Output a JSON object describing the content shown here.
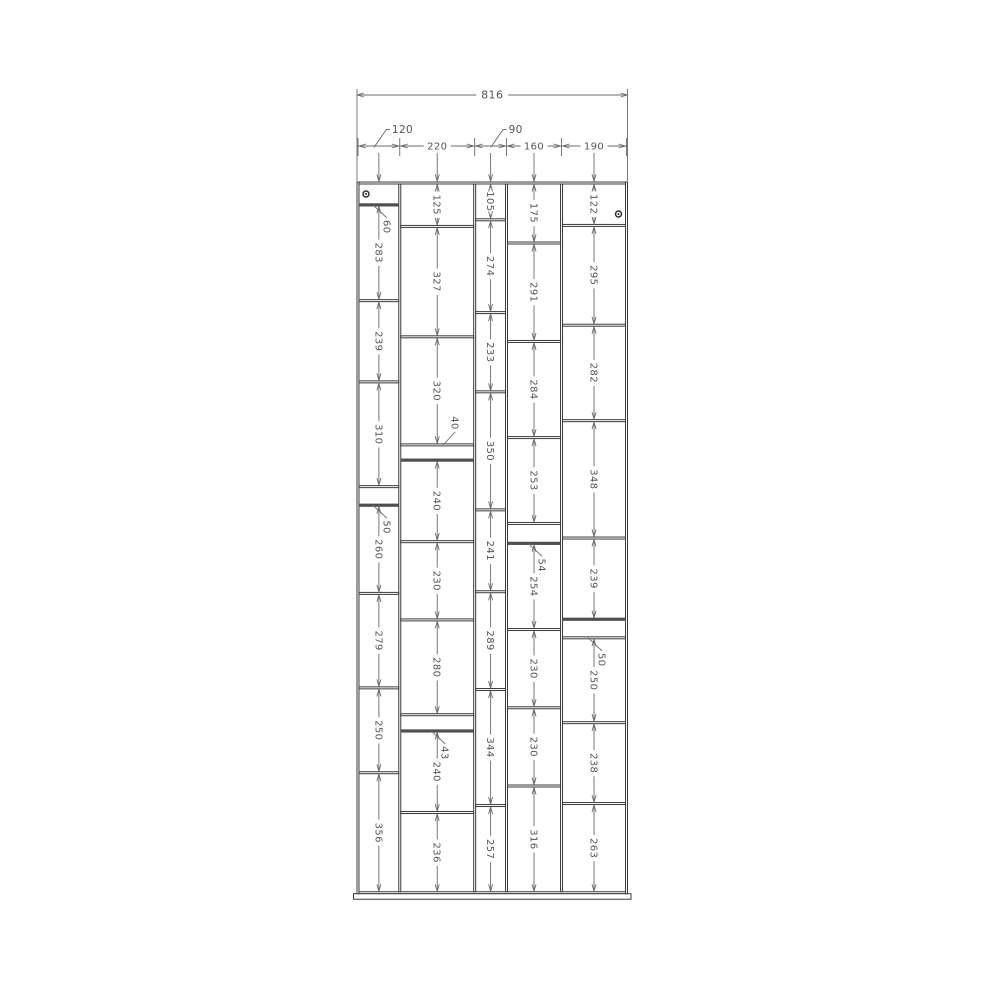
{
  "drawing": {
    "type": "furniture-dimension-drawing",
    "overall_width_label": "816",
    "panel_thickness_mm": 6,
    "column_width_labels": [
      {
        "label": "120",
        "placement": "leader"
      },
      {
        "label": "220",
        "placement": "inline"
      },
      {
        "label": "90",
        "placement": "leader"
      },
      {
        "label": "160",
        "placement": "inline"
      },
      {
        "label": "190",
        "placement": "inline"
      }
    ],
    "columns": [
      {
        "width_mm": 120,
        "screw": "top-left",
        "dark_shelves_after": [
          0,
          4
        ],
        "cells": [
          {
            "h": 60,
            "label": "60",
            "leader": "below"
          },
          {
            "h": 283,
            "label": "283"
          },
          {
            "h": 239,
            "label": "239"
          },
          {
            "h": 310,
            "label": "310"
          },
          {
            "h": 50,
            "label": "50",
            "leader": "below"
          },
          {
            "h": 260,
            "label": "260"
          },
          {
            "h": 279,
            "label": "279"
          },
          {
            "h": 250,
            "label": "250"
          },
          {
            "h": 356,
            "label": "356"
          }
        ]
      },
      {
        "width_mm": 220,
        "dark_shelves_after": [
          3,
          7
        ],
        "cells": [
          {
            "h": 125,
            "label": "125"
          },
          {
            "h": 327,
            "label": "327"
          },
          {
            "h": 320,
            "label": "320"
          },
          {
            "h": 40,
            "label": "40",
            "leader": "above"
          },
          {
            "h": 240,
            "label": "240"
          },
          {
            "h": 230,
            "label": "230"
          },
          {
            "h": 280,
            "label": "280"
          },
          {
            "h": 43,
            "label": "43",
            "leader": "below"
          },
          {
            "h": 240,
            "label": "240"
          },
          {
            "h": 236,
            "label": "236"
          }
        ]
      },
      {
        "width_mm": 90,
        "dark_shelves_after": [],
        "cells": [
          {
            "h": 105,
            "label": "105"
          },
          {
            "h": 274,
            "label": "274"
          },
          {
            "h": 233,
            "label": "233"
          },
          {
            "h": 350,
            "label": "350"
          },
          {
            "h": 241,
            "label": "241"
          },
          {
            "h": 289,
            "label": "289"
          },
          {
            "h": 344,
            "label": "344"
          },
          {
            "h": 257,
            "label": "257"
          }
        ]
      },
      {
        "width_mm": 160,
        "dark_shelves_after": [
          4
        ],
        "cells": [
          {
            "h": 175,
            "label": "175"
          },
          {
            "h": 291,
            "label": "291"
          },
          {
            "h": 284,
            "label": "284"
          },
          {
            "h": 253,
            "label": "253"
          },
          {
            "h": 54,
            "label": "54",
            "leader": "below"
          },
          {
            "h": 254,
            "label": "254"
          },
          {
            "h": 230,
            "label": "230"
          },
          {
            "h": 230,
            "label": "230"
          },
          {
            "h": 316,
            "label": "316"
          }
        ]
      },
      {
        "width_mm": 190,
        "screw": "top-right",
        "dark_shelves_after": [
          4
        ],
        "cells": [
          {
            "h": 122,
            "label": "122"
          },
          {
            "h": 295,
            "label": "295"
          },
          {
            "h": 282,
            "label": "282"
          },
          {
            "h": 348,
            "label": "348"
          },
          {
            "h": 239,
            "label": "239"
          },
          {
            "h": 50,
            "label": "50",
            "leader": "below"
          },
          {
            "h": 250,
            "label": "250"
          },
          {
            "h": 238,
            "label": "238"
          },
          {
            "h": 263,
            "label": "263"
          }
        ]
      }
    ],
    "colors": {
      "background": "#ffffff",
      "panel_line": "#3a3a3a",
      "panel_fill": "#ffffff",
      "highlight_shelf": "#4f4f4f",
      "dimension_line": "#6a6a6a",
      "dimension_text": "#555555",
      "screw": "#2e2e2e"
    }
  }
}
